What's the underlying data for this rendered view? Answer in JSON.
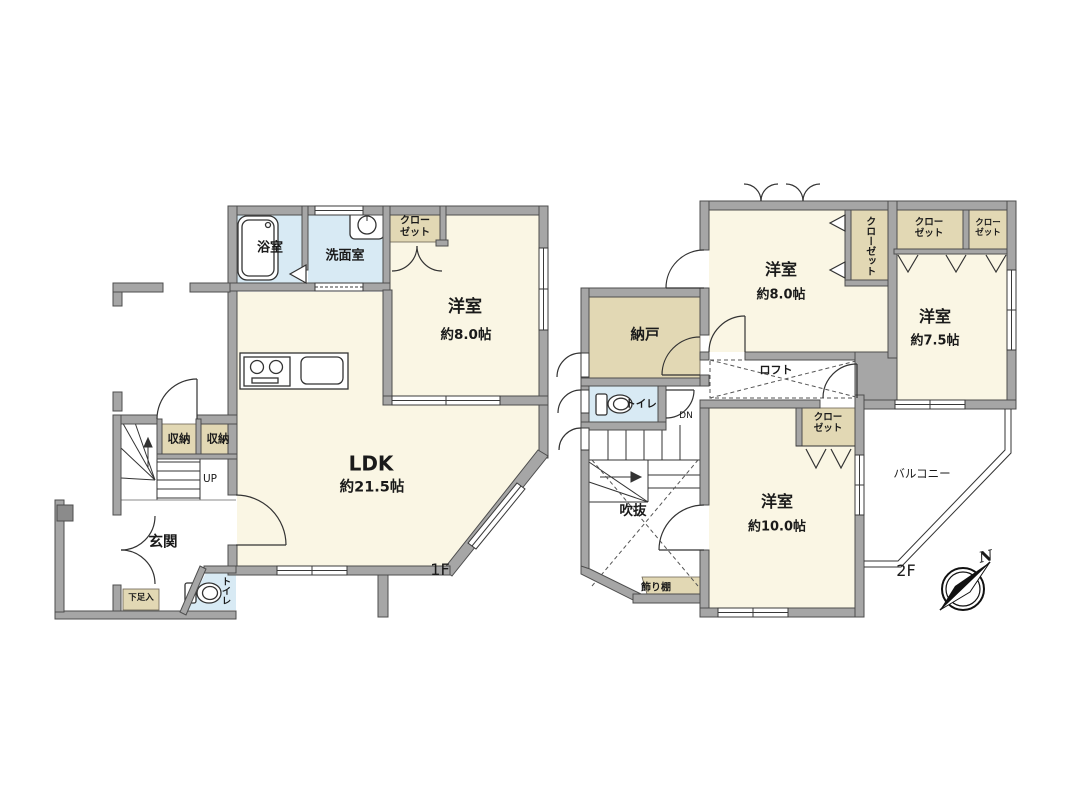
{
  "colors": {
    "wall": "#a6a6a6",
    "wall_edge": "#4d4d4d",
    "room": "#faf6e4",
    "wet_area": "#d8eaf4",
    "closet": "#e2d8b4",
    "background": "#ffffff",
    "line": "#333333"
  },
  "floor1": {
    "label": "1F",
    "bath": "浴室",
    "washroom": "洗面室",
    "closet": "クローゼット",
    "western_room_name": "洋室",
    "western_room_size": "約8.0帖",
    "ldk_name": "LDK",
    "ldk_size": "約21.5帖",
    "storage_left": "収納",
    "storage_right": "収納",
    "stairs_direction": "UP",
    "entrance": "玄関",
    "shoe_cabinet": "下足入",
    "toilet": "トイレ"
  },
  "floor2": {
    "label": "2F",
    "storeroom": "納戸",
    "toilet": "トイレ",
    "stairs_direction": "DN",
    "atrium": "吹抜",
    "display_shelf": "飾り棚",
    "room8_name": "洋室",
    "room8_size": "約8.0帖",
    "closet_vertical": "クローゼット",
    "closet_top_a": "クローゼット",
    "closet_top_b": "クローゼット",
    "room75_name": "洋室",
    "room75_size": "約7.5帖",
    "loft": "ロフト",
    "closet_room10": "クローゼット",
    "room10_name": "洋室",
    "room10_size": "約10.0帖",
    "balcony": "バルコニー",
    "compass_north": "N"
  }
}
